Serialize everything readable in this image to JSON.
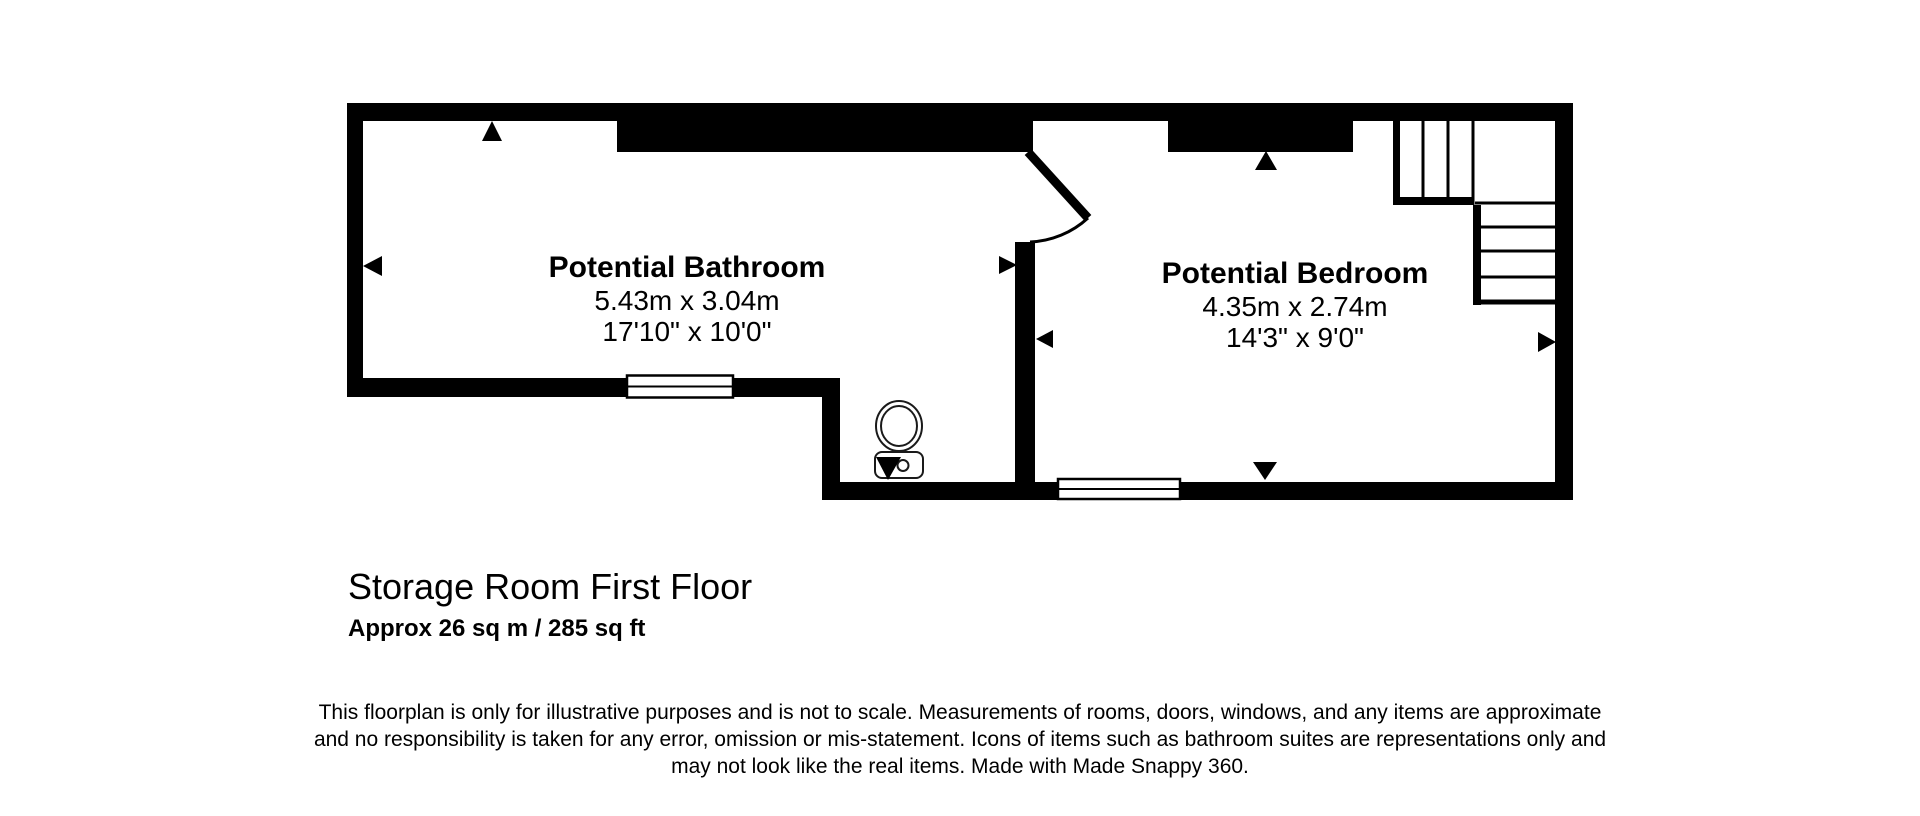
{
  "floorplan": {
    "rooms": [
      {
        "name": "Potential Bathroom",
        "metric": "5.43m x 3.04m",
        "imperial": "17'10\" x 10'0\""
      },
      {
        "name": "Potential Bedroom",
        "metric": "4.35m x 2.74m",
        "imperial": "14'3\" x 9'0\""
      }
    ],
    "icons": {
      "viewpoint_marker": "filled black triangle",
      "toilet": "toilet outline with cistern",
      "window": "white bar with pane line",
      "door": "diagonal leaf with quarter-circle swing arc",
      "staircase": "L-shaped stair with treads and landing"
    },
    "colors": {
      "wall": "#000000",
      "background": "#ffffff",
      "fixture_outline": "#1a1a1a"
    }
  },
  "caption": {
    "title": "Storage Room First Floor",
    "area": "Approx 26 sq m / 285 sq ft"
  },
  "disclaimer": {
    "line1": "This floorplan is only for illustrative purposes and is not to scale. Measurements of rooms, doors, windows, and any items are approximate",
    "line2": "and no responsibility is taken for any error, omission or mis-statement. Icons of items such as bathroom suites are representations only and",
    "line3": "may not look like the real items. Made with Made Snappy 360."
  }
}
